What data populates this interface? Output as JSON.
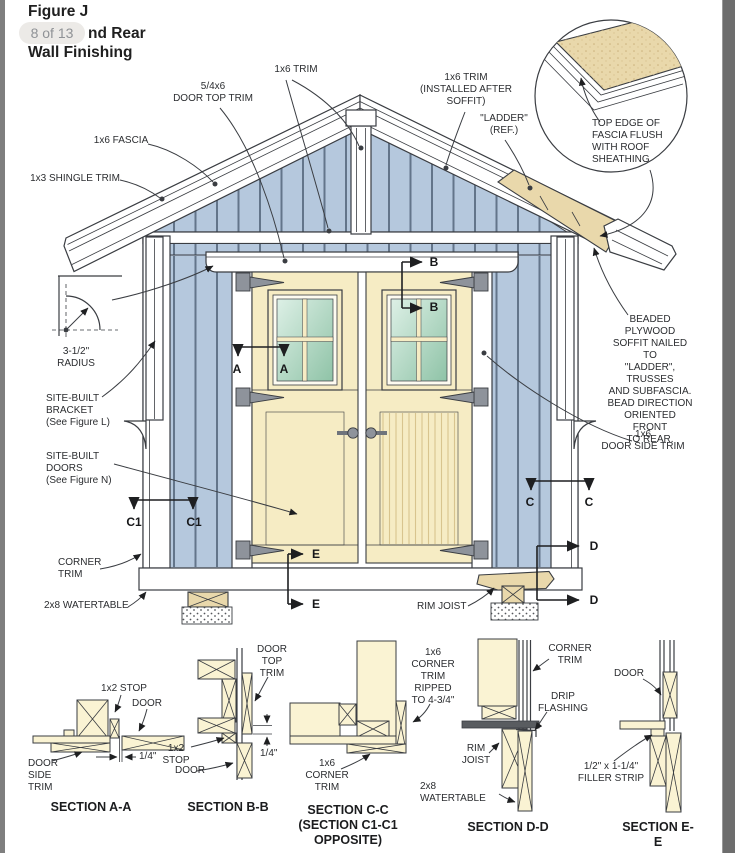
{
  "viewer": {
    "page_indicator": "8 of 13"
  },
  "title": {
    "line1": "Figure J",
    "line2_visible": "nd Rear",
    "line3": "Wall Finishing"
  },
  "colors": {
    "siding": "#b5c8dd",
    "door": "#f6ecc4",
    "lumber": "#faf3d3",
    "sheathing": "#e9d8ab",
    "hinge": "#8e939b",
    "outline": "#3a3d42"
  },
  "labels": {
    "door_top_trim": "5/4x6\nDOOR TOP TRIM",
    "trim_1x6": "1x6 TRIM",
    "trim_1x6_soffit": "1x6 TRIM\n(INSTALLED AFTER\nSOFFIT)",
    "ladder_ref": "\"LADDER\"\n(REF.)",
    "detail_note": "TOP EDGE OF\nFASCIA FLUSH\nWITH ROOF\nSHEATHING",
    "fascia_1x6": "1x6 FASCIA",
    "shingle_trim_1x3": "1x3 SHINGLE TRIM",
    "radius": "3-1/2\"\nRADIUS",
    "site_built_bracket": "SITE-BUILT\nBRACKET\n(See Figure L)",
    "site_built_doors": "SITE-BUILT\nDOORS\n(See Figure N)",
    "corner_trim": "CORNER\nTRIM",
    "watertable_2x8": "2x8 WATERTABLE",
    "rim_joist": "RIM JOIST",
    "soffit_note": "BEADED PLYWOOD\nSOFFIT NAILED TO\n\"LADDER\", TRUSSES\nAND SUBFASCIA.\nBEAD DIRECTION\nORIENTED FRONT\nTO REAR.",
    "door_side_trim": "1x6\nDOOR SIDE TRIM"
  },
  "markers": {
    "a": "A",
    "b": "B",
    "c": "C",
    "c1": "C1",
    "d": "D",
    "e": "E"
  },
  "sections": {
    "aa": {
      "caption": "SECTION A-A",
      "stop": "1x2 STOP",
      "door": "DOOR",
      "side_trim": "DOOR\nSIDE\nTRIM",
      "dim": "1/4\""
    },
    "bb": {
      "caption": "SECTION B-B",
      "top_trim": "DOOR\nTOP\nTRIM",
      "stop": "1x2\nSTOP",
      "door": "DOOR",
      "dim": "1/4\""
    },
    "cc": {
      "caption": "SECTION C-C\n(SECTION C1-C1\nOPPOSITE)",
      "trim_ripped": "1x6\nCORNER\nTRIM\nRIPPED\nTO 4-3/4\"",
      "trim": "1x6\nCORNER\nTRIM"
    },
    "dd": {
      "caption": "SECTION D-D",
      "corner_trim": "CORNER\nTRIM",
      "drip": "DRIP\nFLASHING",
      "rim": "RIM\nJOIST",
      "watertable": "2x8\nWATERTABLE"
    },
    "ee": {
      "caption": "SECTION E-E",
      "door": "DOOR",
      "filler": "1/2\" x 1-1/4\"\nFILLER STRIP"
    }
  }
}
